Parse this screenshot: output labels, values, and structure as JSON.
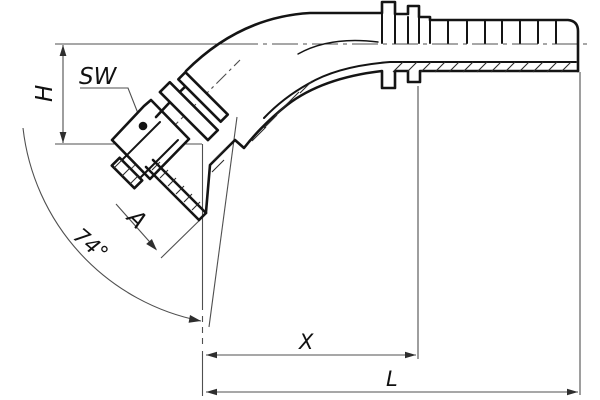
{
  "drawing": {
    "title": "45-degree elbow hose fitting, sectioned technical drawing",
    "labels": {
      "sw": "SW",
      "h": "H",
      "a": "A",
      "angle": "74°",
      "x": "X",
      "l": "L"
    }
  },
  "colors": {
    "background": "#ffffff",
    "outline": "#141414",
    "dimension_line": "#4f4f4f",
    "arrow_fill": "#2e2e2e",
    "hatch": "#2a2a2a",
    "text": "#111111"
  }
}
